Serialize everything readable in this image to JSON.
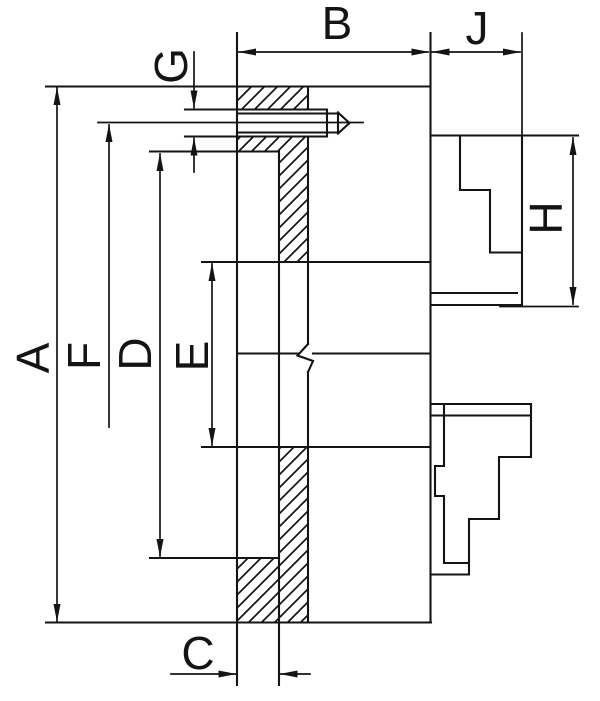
{
  "drawing": {
    "background": "#ffffff",
    "line_color": "#141414",
    "labels": {
      "A": "A",
      "B": "B",
      "C": "C",
      "D": "D",
      "E": "E",
      "F": "F",
      "G": "G",
      "H": "H",
      "J": "J"
    }
  }
}
